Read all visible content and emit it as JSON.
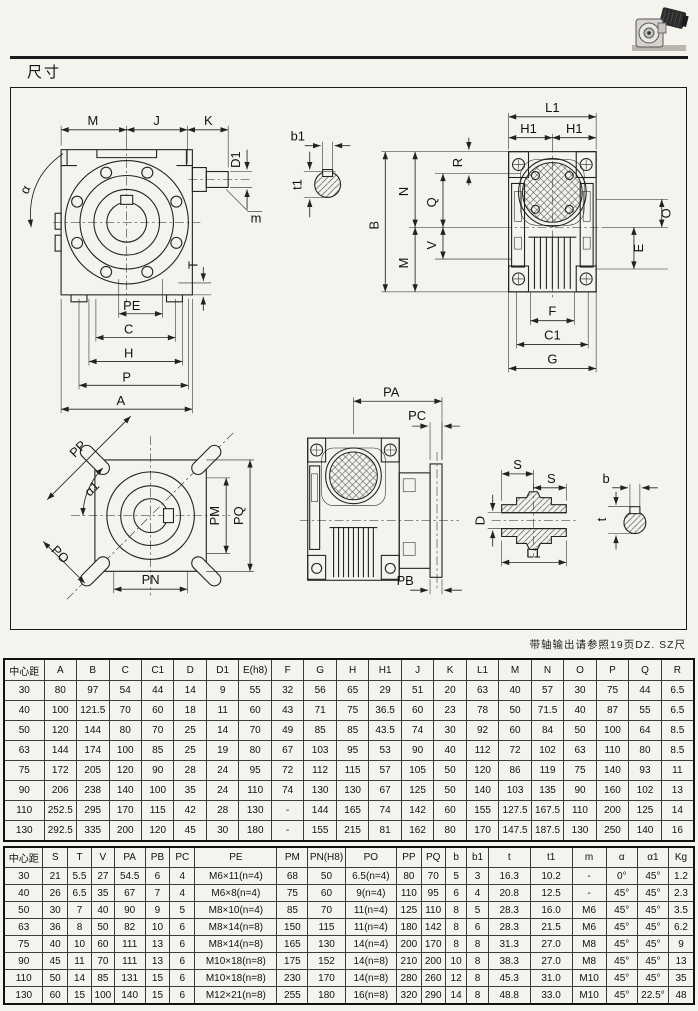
{
  "header": {
    "section_title": "尺寸"
  },
  "drawing": {
    "note": "带轴输出请参照19页DZ. SZ尺"
  },
  "dims": {
    "M": "M",
    "J": "J",
    "K": "K",
    "D1": "D1",
    "m": "m",
    "alpha": "α",
    "T": "T",
    "PE": "PE",
    "C": "C",
    "H": "H",
    "P": "P",
    "A": "A",
    "b1": "b1",
    "t1": "t1",
    "L1": "L1",
    "H1": "H1",
    "B": "B",
    "N": "N",
    "Q": "Q",
    "V": "V",
    "R": "R",
    "O": "O",
    "E": "E",
    "F": "F",
    "C1": "C1",
    "G": "G",
    "PP": "PP",
    "alpha1": "α1",
    "PO": "PO",
    "PM": "PM",
    "PQ": "PQ",
    "PN": "PN",
    "PA": "PA",
    "PC": "PC",
    "PB": "PB",
    "S": "S",
    "D": "D",
    "b": "b",
    "t": "t"
  },
  "table1": {
    "headers": [
      "中心距",
      "A",
      "B",
      "C",
      "C1",
      "D",
      "D1",
      "E(h8)",
      "F",
      "G",
      "H",
      "H1",
      "J",
      "K",
      "L1",
      "M",
      "N",
      "O",
      "P",
      "Q",
      "R"
    ],
    "rows": [
      [
        "30",
        "80",
        "97",
        "54",
        "44",
        "14",
        "9",
        "55",
        "32",
        "56",
        "65",
        "29",
        "51",
        "20",
        "63",
        "40",
        "57",
        "30",
        "75",
        "44",
        "6.5"
      ],
      [
        "40",
        "100",
        "121.5",
        "70",
        "60",
        "18",
        "11",
        "60",
        "43",
        "71",
        "75",
        "36.5",
        "60",
        "23",
        "78",
        "50",
        "71.5",
        "40",
        "87",
        "55",
        "6.5"
      ],
      [
        "50",
        "120",
        "144",
        "80",
        "70",
        "25",
        "14",
        "70",
        "49",
        "85",
        "85",
        "43.5",
        "74",
        "30",
        "92",
        "60",
        "84",
        "50",
        "100",
        "64",
        "8.5"
      ],
      [
        "63",
        "144",
        "174",
        "100",
        "85",
        "25",
        "19",
        "80",
        "67",
        "103",
        "95",
        "53",
        "90",
        "40",
        "112",
        "72",
        "102",
        "63",
        "110",
        "80",
        "8.5"
      ],
      [
        "75",
        "172",
        "205",
        "120",
        "90",
        "28",
        "24",
        "95",
        "72",
        "112",
        "115",
        "57",
        "105",
        "50",
        "120",
        "86",
        "119",
        "75",
        "140",
        "93",
        "11"
      ],
      [
        "90",
        "206",
        "238",
        "140",
        "100",
        "35",
        "24",
        "110",
        "74",
        "130",
        "130",
        "67",
        "125",
        "50",
        "140",
        "103",
        "135",
        "90",
        "160",
        "102",
        "13"
      ],
      [
        "110",
        "252.5",
        "295",
        "170",
        "115",
        "42",
        "28",
        "130",
        "-",
        "144",
        "165",
        "74",
        "142",
        "60",
        "155",
        "127.5",
        "167.5",
        "110",
        "200",
        "125",
        "14"
      ],
      [
        "130",
        "292.5",
        "335",
        "200",
        "120",
        "45",
        "30",
        "180",
        "-",
        "155",
        "215",
        "81",
        "162",
        "80",
        "170",
        "147.5",
        "187.5",
        "130",
        "250",
        "140",
        "16"
      ]
    ]
  },
  "table2": {
    "headers": [
      "中心距",
      "S",
      "T",
      "V",
      "PA",
      "PB",
      "PC",
      "PE",
      "PM",
      "PN(H8)",
      "PO",
      "PP",
      "PQ",
      "b",
      "b1",
      "t",
      "t1",
      "m",
      "α",
      "α1",
      "Kg"
    ],
    "rows": [
      [
        "30",
        "21",
        "5.5",
        "27",
        "54.5",
        "6",
        "4",
        "M6×11(n=4)",
        "68",
        "50",
        "6.5(n=4)",
        "80",
        "70",
        "5",
        "3",
        "16.3",
        "10.2",
        "-",
        "0°",
        "45°",
        "1.2"
      ],
      [
        "40",
        "26",
        "6.5",
        "35",
        "67",
        "7",
        "4",
        "M6×8(n=4)",
        "75",
        "60",
        "9(n=4)",
        "110",
        "95",
        "6",
        "4",
        "20.8",
        "12.5",
        "-",
        "45°",
        "45°",
        "2.3"
      ],
      [
        "50",
        "30",
        "7",
        "40",
        "90",
        "9",
        "5",
        "M8×10(n=4)",
        "85",
        "70",
        "11(n=4)",
        "125",
        "110",
        "8",
        "5",
        "28.3",
        "16.0",
        "M6",
        "45°",
        "45°",
        "3.5"
      ],
      [
        "63",
        "36",
        "8",
        "50",
        "82",
        "10",
        "6",
        "M8×14(n=8)",
        "150",
        "115",
        "11(n=4)",
        "180",
        "142",
        "8",
        "6",
        "28.3",
        "21.5",
        "M6",
        "45°",
        "45°",
        "6.2"
      ],
      [
        "75",
        "40",
        "10",
        "60",
        "111",
        "13",
        "6",
        "M8×14(n=8)",
        "165",
        "130",
        "14(n=4)",
        "200",
        "170",
        "8",
        "8",
        "31.3",
        "27.0",
        "M8",
        "45°",
        "45°",
        "9"
      ],
      [
        "90",
        "45",
        "11",
        "70",
        "111",
        "13",
        "6",
        "M10×18(n=8)",
        "175",
        "152",
        "14(n=8)",
        "210",
        "200",
        "10",
        "8",
        "38.3",
        "27.0",
        "M8",
        "45°",
        "45°",
        "13"
      ],
      [
        "110",
        "50",
        "14",
        "85",
        "131",
        "15",
        "6",
        "M10×18(n=8)",
        "230",
        "170",
        "14(n=8)",
        "280",
        "260",
        "12",
        "8",
        "45.3",
        "31.0",
        "M10",
        "45°",
        "45°",
        "35"
      ],
      [
        "130",
        "60",
        "15",
        "100",
        "140",
        "15",
        "6",
        "M12×21(n=8)",
        "255",
        "180",
        "16(n=8)",
        "320",
        "290",
        "14",
        "8",
        "48.8",
        "33.0",
        "M10",
        "45°",
        "22.5°",
        "48"
      ]
    ]
  }
}
